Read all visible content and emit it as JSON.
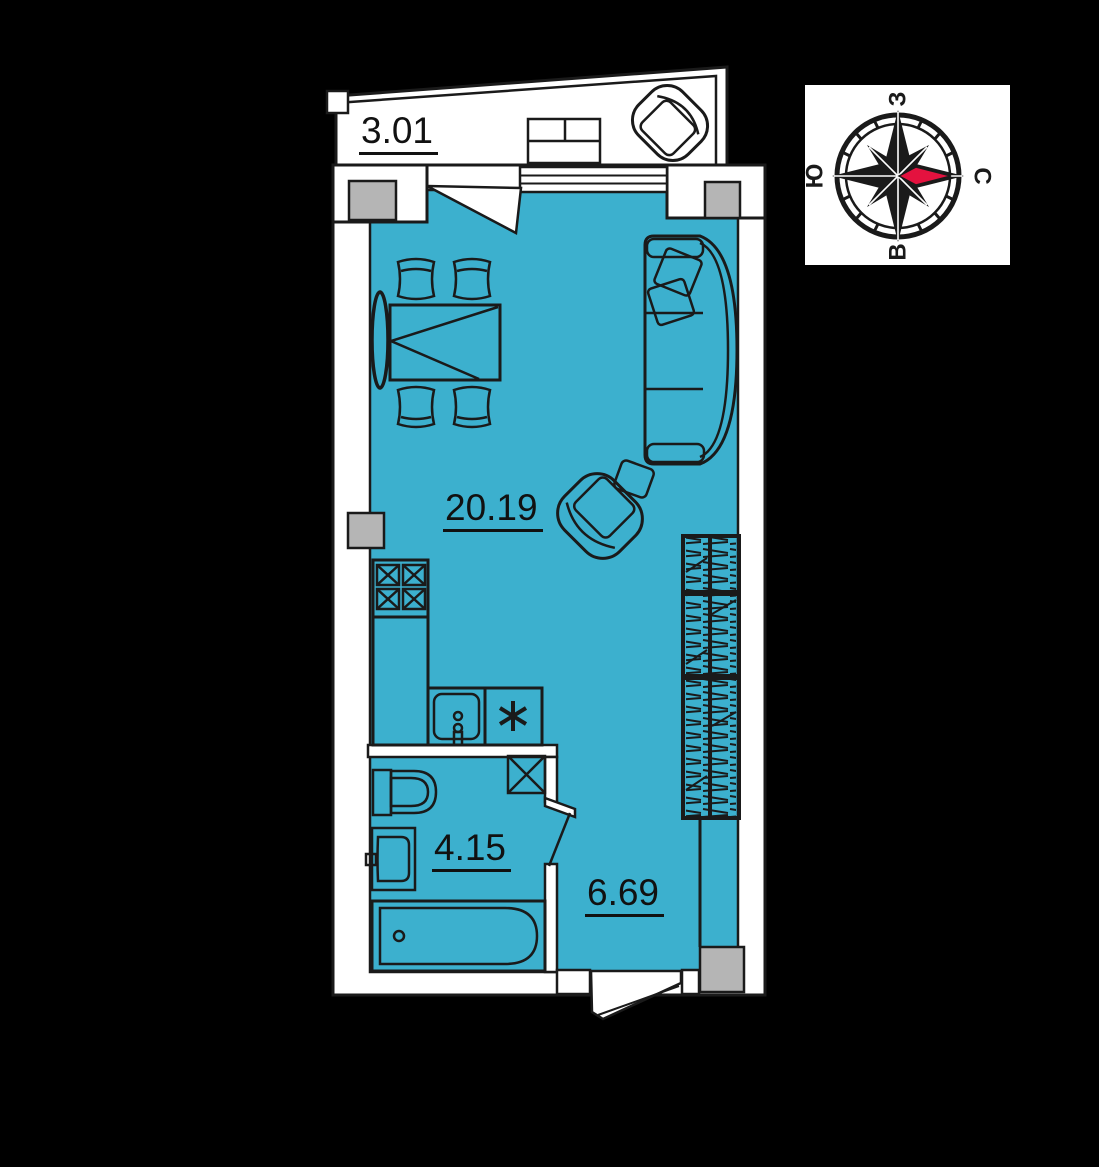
{
  "plan": {
    "floor_color": "#3cb0ce",
    "wall_color": "#ffffff",
    "outline_color": "#1a1a1a",
    "column_color": "#b5b5b5",
    "rooms": [
      {
        "id": "balcony",
        "area_label": "3.01"
      },
      {
        "id": "living-kitchen",
        "area_label": "20.19"
      },
      {
        "id": "bathroom",
        "area_label": "4.15"
      },
      {
        "id": "hallway",
        "area_label": "6.69"
      }
    ]
  },
  "compass": {
    "north_label": "С",
    "south_label": "Ю",
    "west_label": "З",
    "east_label": "В",
    "needle_color": "#e4123f"
  }
}
